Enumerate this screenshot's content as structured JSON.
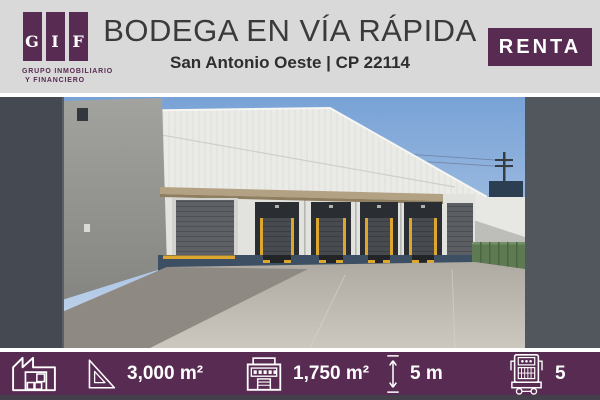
{
  "brand": {
    "letters": [
      "G",
      "I",
      "F"
    ],
    "line1": "GRUPO INMOBILIARIO",
    "line2": "Y FINANCIERO"
  },
  "header": {
    "title": "BODEGA EN VÍA RÁPIDA",
    "subtitle": "San Antonio Oeste | CP 22114",
    "badge_label": "RENTA"
  },
  "photo": {
    "description": "Warehouse with white sloped metal facade, four loading docks with black shelters and yellow stripes over a navy base, concrete yard"
  },
  "stats": {
    "items": [
      {
        "icon": "factory-icon",
        "value": ""
      },
      {
        "icon": "set-square-icon",
        "value": "3,000 m²"
      },
      {
        "icon": "warehouse-front-icon",
        "value": "1,750 m²"
      },
      {
        "icon": "height-arrow-icon",
        "value": "5 m"
      },
      {
        "icon": "truck-icon",
        "value": "5"
      }
    ]
  },
  "colors": {
    "purple": "#582b52",
    "header-bg": "#d9d9d9",
    "navy": "#3d4f63",
    "yellow": "#dca62f"
  }
}
